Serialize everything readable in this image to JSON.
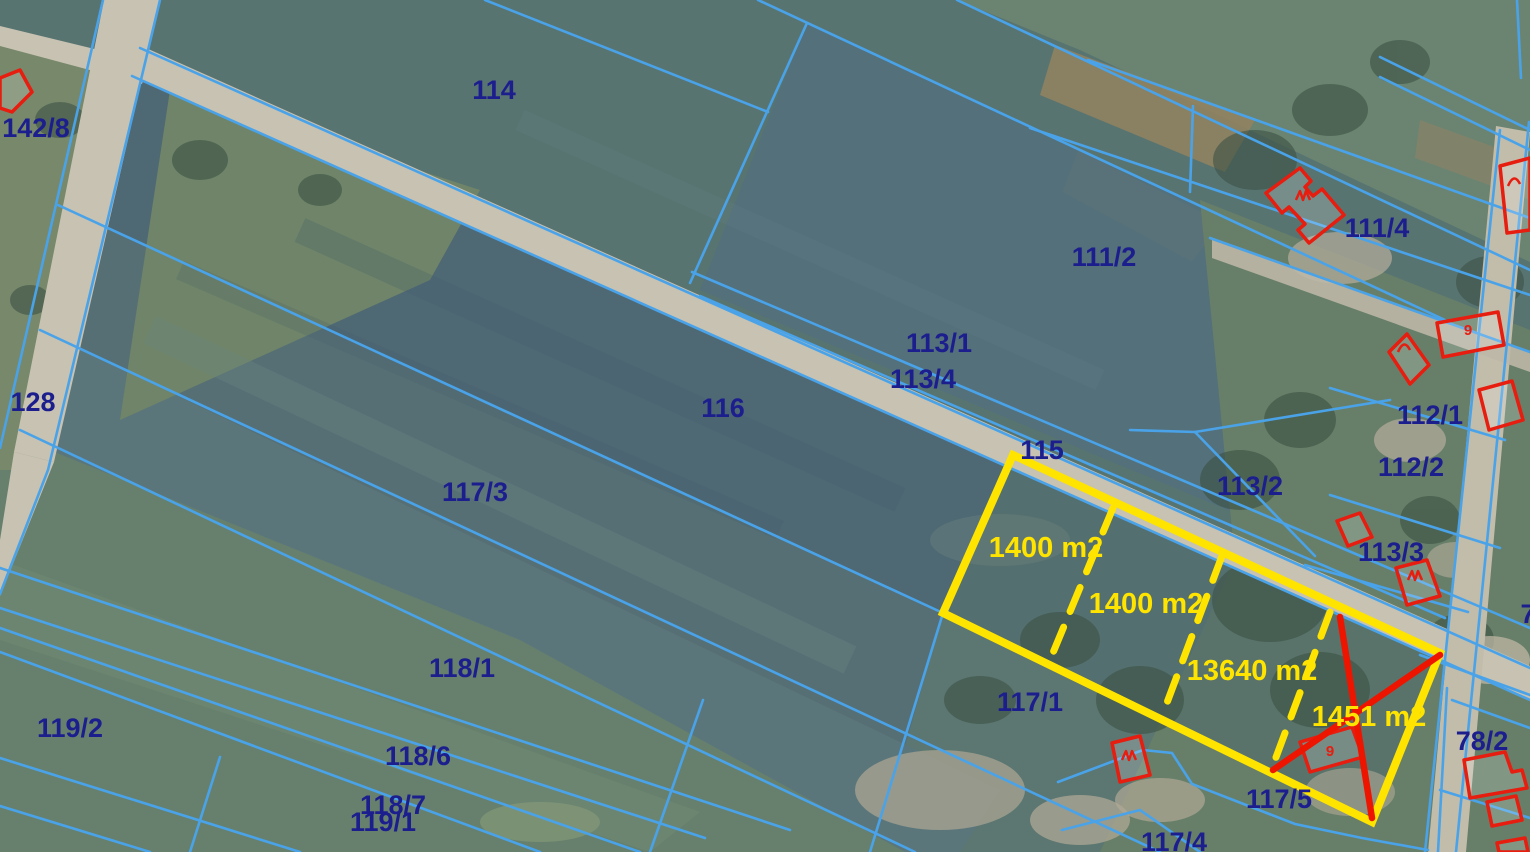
{
  "map": {
    "parcels": {
      "p142_8": "142/8",
      "p114": "114",
      "p128": "128",
      "p116": "116",
      "p117_3": "117/3",
      "p113_1": "113/1",
      "p113_4": "113/4",
      "p115": "115",
      "p111_2": "111/2",
      "p111_4": "111/4",
      "p113_2": "113/2",
      "p112_1": "112/1",
      "p112_2": "112/2",
      "p113_3": "113/3",
      "p117_1": "117/1",
      "p118_1": "118/1",
      "p119_2": "119/2",
      "p118_6": "118/6",
      "p118_7": "118/7",
      "p119_1": "119/1",
      "p117_5": "117/5",
      "p117_4": "117/4",
      "p78_2": "78/2",
      "p7": "7"
    },
    "areas": {
      "a1": "1400 m2",
      "a2": "1400 m2",
      "a3": "13640 m2",
      "a4": "1451 m2"
    },
    "glyphs": {
      "g5": "9",
      "g9": "9"
    },
    "colors": {
      "boundary_blue": "#4aa3e8",
      "label_navy": "#1c1e8e",
      "highlight_yellow": "#ffe400",
      "building_red": "#e61d0f",
      "road_gray": "#c8c2b2"
    }
  }
}
